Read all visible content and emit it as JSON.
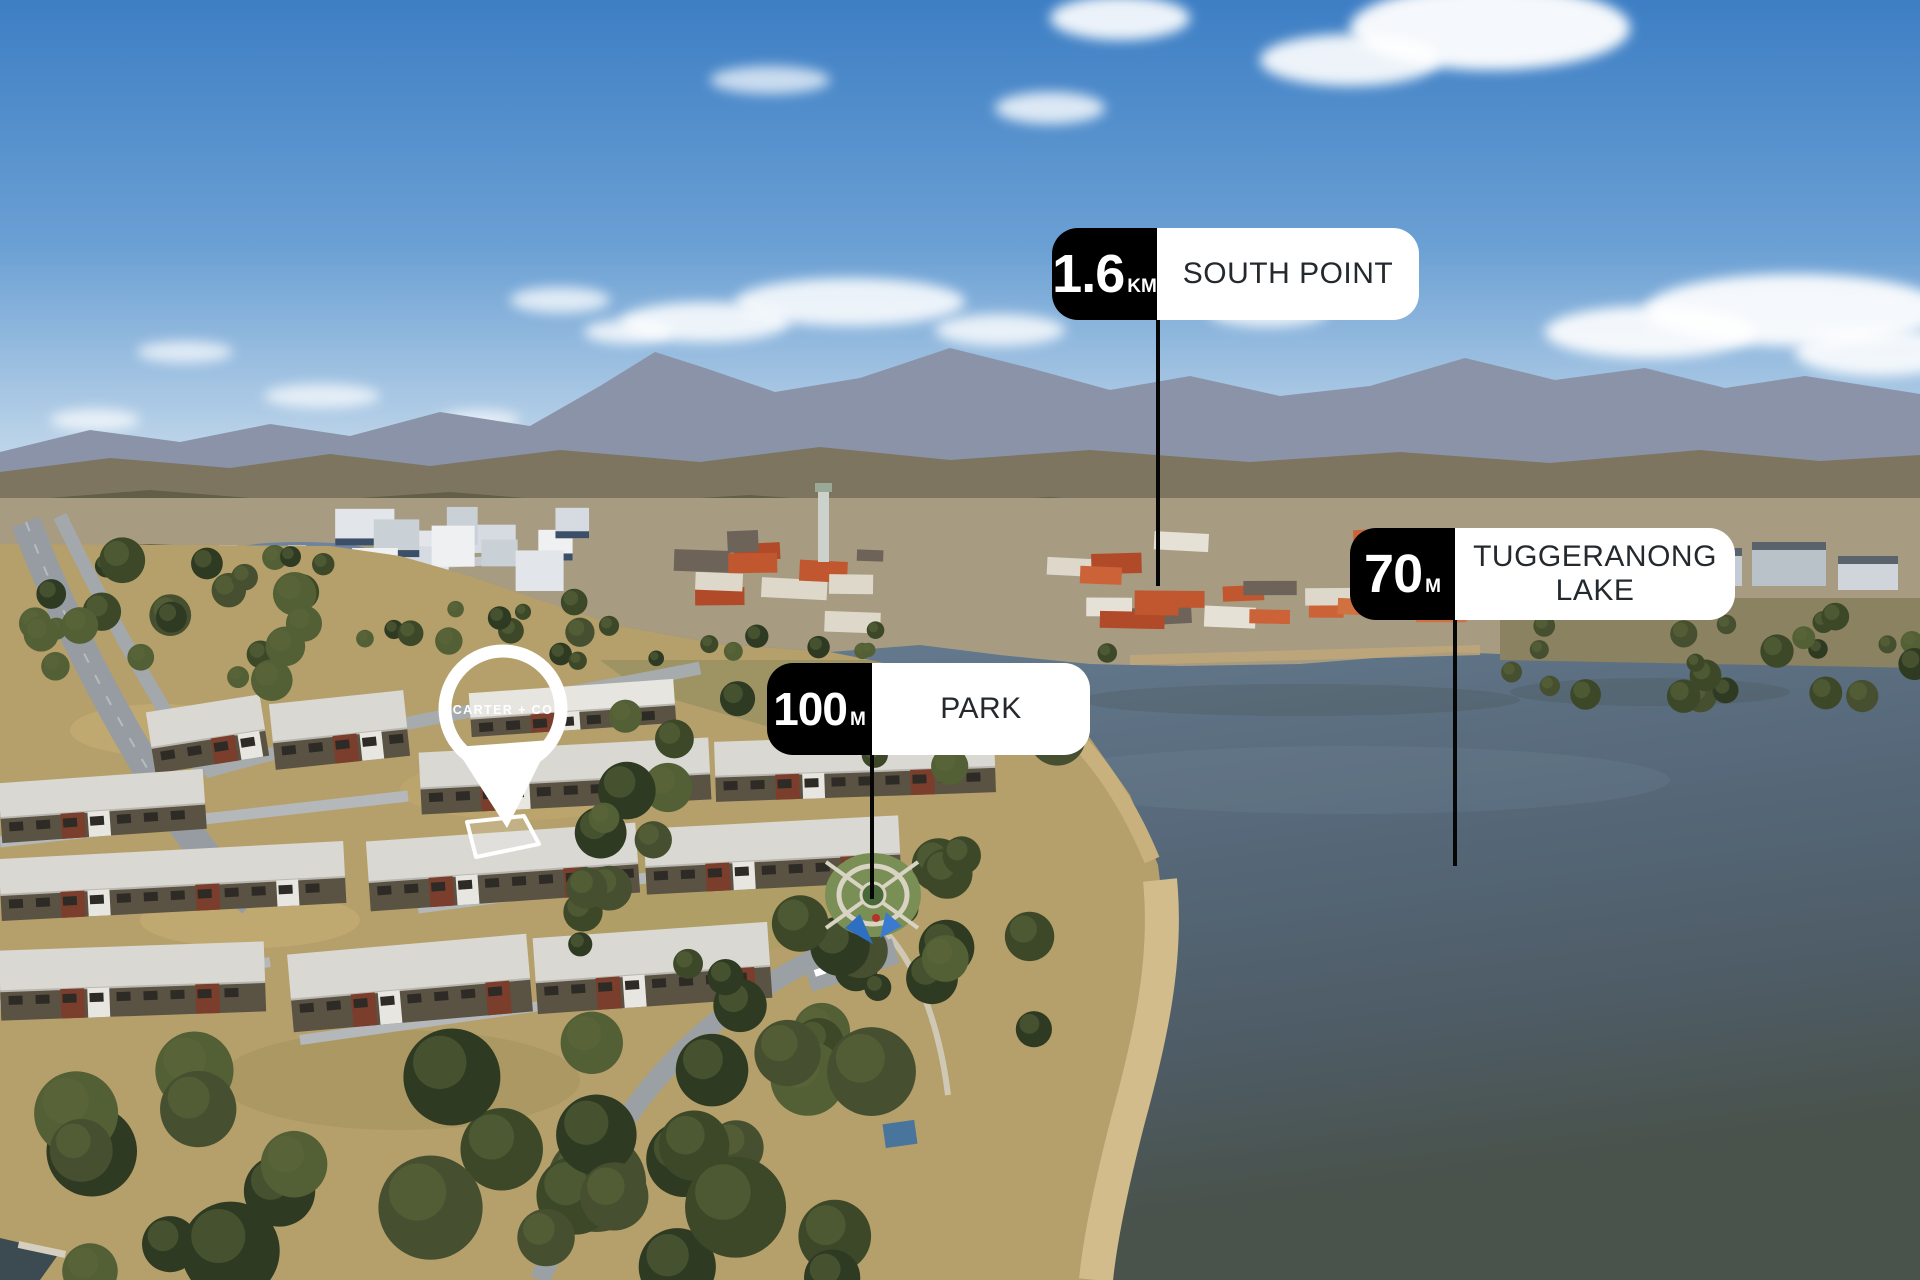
{
  "scene": {
    "description": "Aerial drone photo of a lakeside townhouse suburb beside a town centre, lake and distant mountain ranges under a blue sky with scattered clouds",
    "colors": {
      "sky_top": "#3d7ec4",
      "sky_horizon": "#dce9f2",
      "mountains_far": "#8a93a8",
      "hills": "#7d7560",
      "town_ground": "#a79b82",
      "roof_terracotta": "#c0572f",
      "lake_top": "#7e93a5",
      "lake_bottom": "#49524b",
      "dry_grass": "#b5a06b",
      "trees": "#465030",
      "sand": "#d2bc8c",
      "marker_black": "#000000",
      "marker_white": "#ffffff",
      "marker_text": "#24292e",
      "leader_line": "#060606",
      "pin": "#ffffff"
    }
  },
  "markers": [
    {
      "id": "south-point",
      "distance": "1.6",
      "unit": "KM",
      "name": "SOUTH POINT"
    },
    {
      "id": "tuggeranong-lake",
      "distance": "70",
      "unit": "M",
      "name": "TUGGERANONG LAKE"
    },
    {
      "id": "park",
      "distance": "100",
      "unit": "M",
      "name": "PARK"
    }
  ],
  "pin": {
    "brand": "CARTER + CO"
  }
}
